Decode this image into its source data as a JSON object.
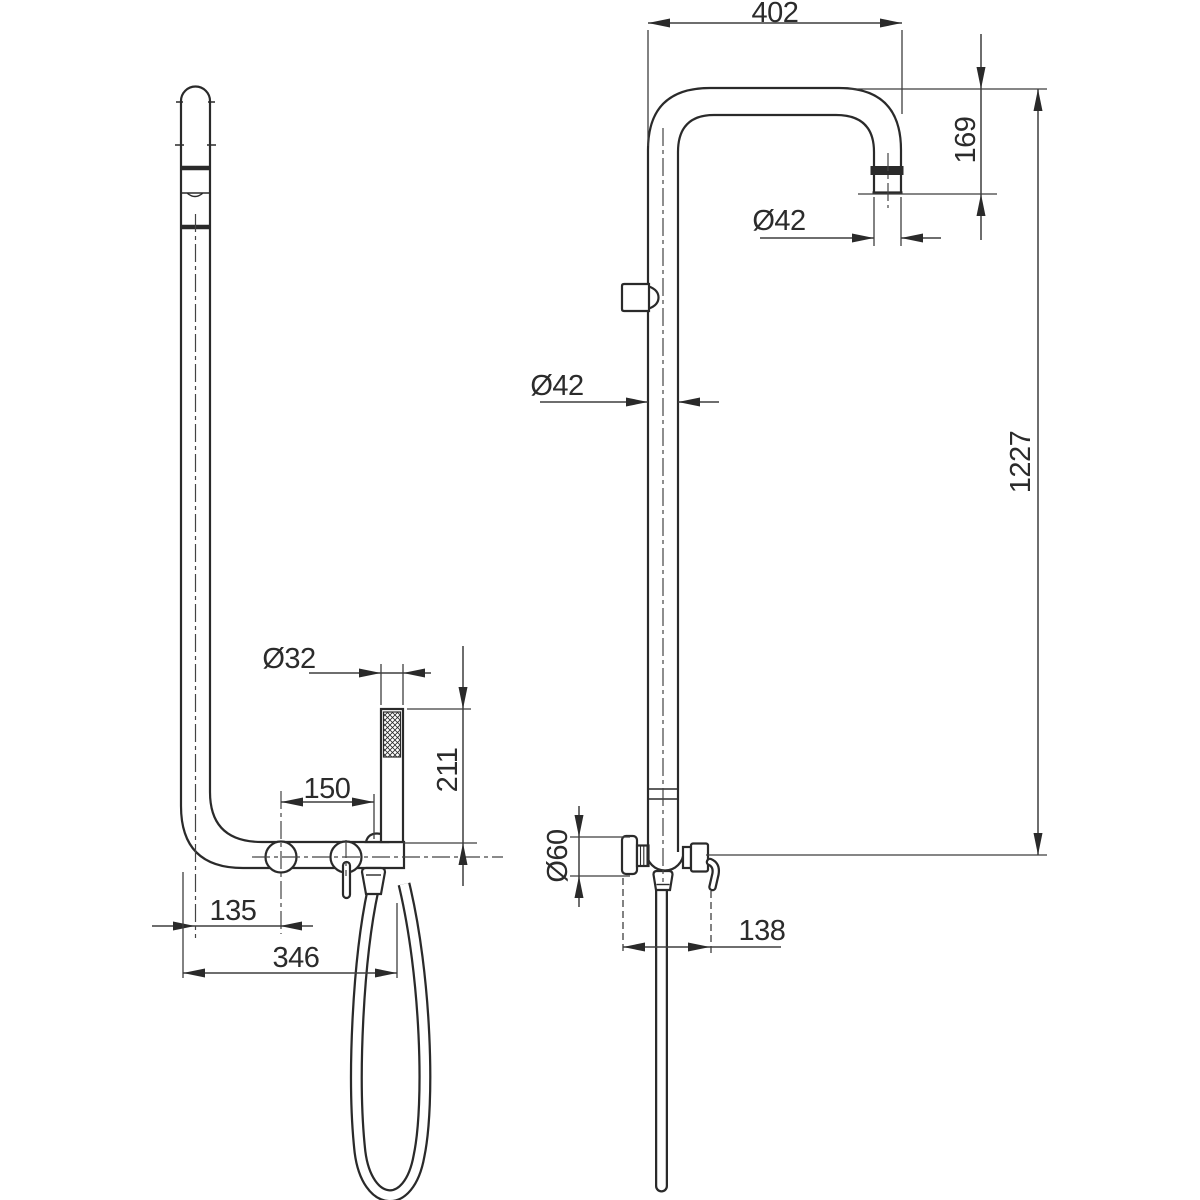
{
  "drawing": {
    "kind": "technical-dimension-drawing",
    "subject": "wall-mounted shower column with hand shower, two orthographic views",
    "colors": {
      "line": "#2a2a2a",
      "dimension": "#3f3f3f",
      "text": "#2b2b2b",
      "background": "#ffffff"
    },
    "views": {
      "side_view": {
        "name": "side view",
        "dimensions": [
          {
            "id": "dia32",
            "label": "Ø32",
            "value": 32,
            "kind": "diameter"
          },
          {
            "id": "d211",
            "label": "211",
            "value": 211,
            "kind": "length"
          },
          {
            "id": "d150",
            "label": "150",
            "value": 150,
            "kind": "length"
          },
          {
            "id": "d135",
            "label": "135",
            "value": 135,
            "kind": "length"
          },
          {
            "id": "d346",
            "label": "346",
            "value": 346,
            "kind": "length"
          }
        ]
      },
      "front_view": {
        "name": "front view",
        "dimensions": [
          {
            "id": "d402",
            "label": "402",
            "value": 402,
            "kind": "length"
          },
          {
            "id": "d169",
            "label": "169",
            "value": 169,
            "kind": "length"
          },
          {
            "id": "dia42_top",
            "label": "Ø42",
            "value": 42,
            "kind": "diameter"
          },
          {
            "id": "dia42_mid",
            "label": "Ø42",
            "value": 42,
            "kind": "diameter"
          },
          {
            "id": "d1227",
            "label": "1227",
            "value": 1227,
            "kind": "length"
          },
          {
            "id": "dia60",
            "label": "Ø60",
            "value": 60,
            "kind": "diameter"
          },
          {
            "id": "d138",
            "label": "138",
            "value": 138,
            "kind": "length"
          }
        ]
      }
    }
  }
}
